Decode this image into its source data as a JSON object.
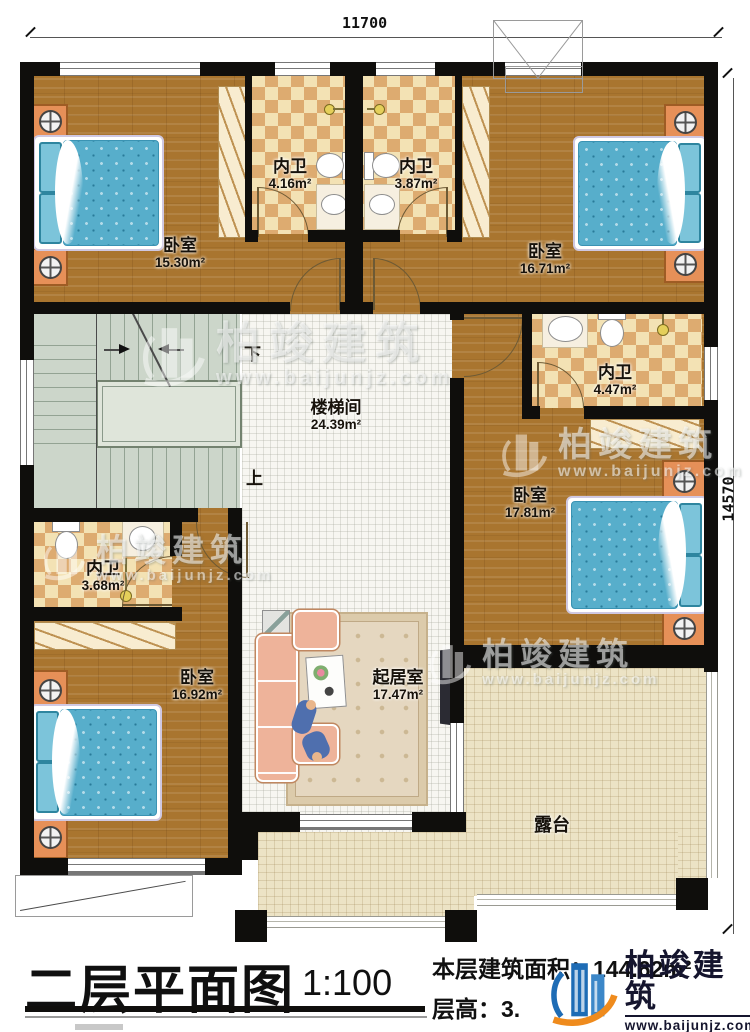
{
  "dimensions": {
    "top": "11700",
    "right": "14570"
  },
  "stairs": {
    "label": "楼梯间",
    "area": "24.39m²",
    "down": "下",
    "up": "上"
  },
  "rooms": {
    "bedroom1": {
      "label": "卧室",
      "area": "15.30m²"
    },
    "bath1": {
      "label": "内卫",
      "area": "4.16m²"
    },
    "bath2": {
      "label": "内卫",
      "area": "3.87m²"
    },
    "bedroom2": {
      "label": "卧室",
      "area": "16.71m²"
    },
    "bath3": {
      "label": "内卫",
      "area": "4.47m²"
    },
    "bedroom3": {
      "label": "卧室",
      "area": "17.81m²"
    },
    "bath4": {
      "label": "内卫",
      "area": "3.68m²"
    },
    "bedroom4": {
      "label": "卧室",
      "area": "16.92m²"
    },
    "living": {
      "label": "起居室",
      "area": "17.47m²"
    },
    "terrace": {
      "label": "露台"
    }
  },
  "title_block": {
    "title": "二层平面图",
    "scale": "1:100",
    "area_line": "本层建筑面积：144.62m²",
    "height_line": "层高：3."
  },
  "brand": {
    "name": "柏竣建筑",
    "website": "www.baijunjz.com"
  },
  "colors": {
    "wall": "#0f0e0c",
    "wood": "#a9752f",
    "tile_light": "#f3e2b4",
    "tile_dark": "#ddab70",
    "stair": "#ccd6ca",
    "bed_blue": "#57aecb",
    "nightstand": "#e69058",
    "logo_blue": "#1e6cb5",
    "logo_orange": "#ef8b1d"
  }
}
